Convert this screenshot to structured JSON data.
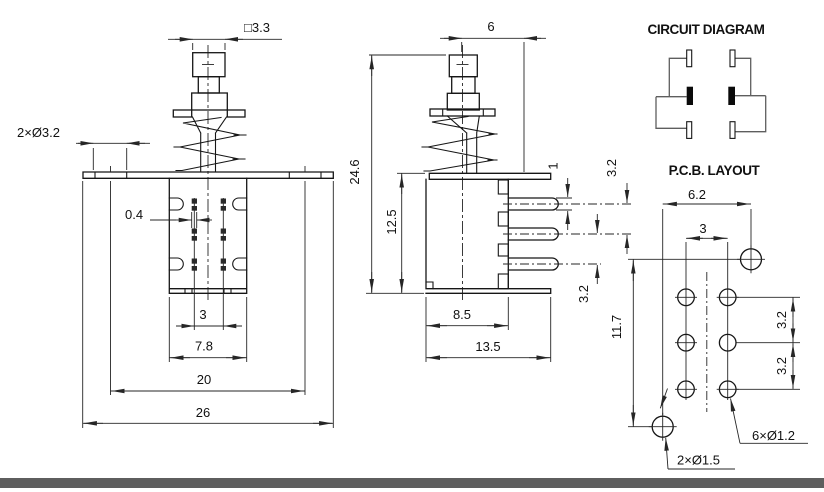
{
  "drawing": {
    "front_view": {
      "dims": {
        "cap_width": "□3.3",
        "mount_holes": "2×Ø3.2",
        "terminal_width": "0.4",
        "terminal_spacing": "3",
        "body_width": "7.8",
        "hole_spacing": "20",
        "flange_width": "26"
      }
    },
    "side_view": {
      "dims": {
        "button_offset": "6",
        "total_height": "24.6",
        "body_height": "12.5",
        "pin_thickness": "1",
        "pin_pitch_upper": "3.2",
        "pin_pitch_lower": "3.2",
        "body_depth": "8.5",
        "flange_depth": "13.5"
      }
    },
    "circuit_diagram": {
      "title": "CIRCUIT DIAGRAM"
    },
    "pcb_layout": {
      "title": "P.C.B. LAYOUT",
      "dims": {
        "mount_hole_span_x": "6.2",
        "pin_col_spacing": "3",
        "mount_hole_span_y": "11.7",
        "pin_row_pitch_upper": "3.2",
        "pin_row_pitch_lower": "3.2"
      },
      "leaders": {
        "pin_holes": "6×Ø1.2",
        "mount_holes": "2×Ø1.5"
      }
    }
  }
}
